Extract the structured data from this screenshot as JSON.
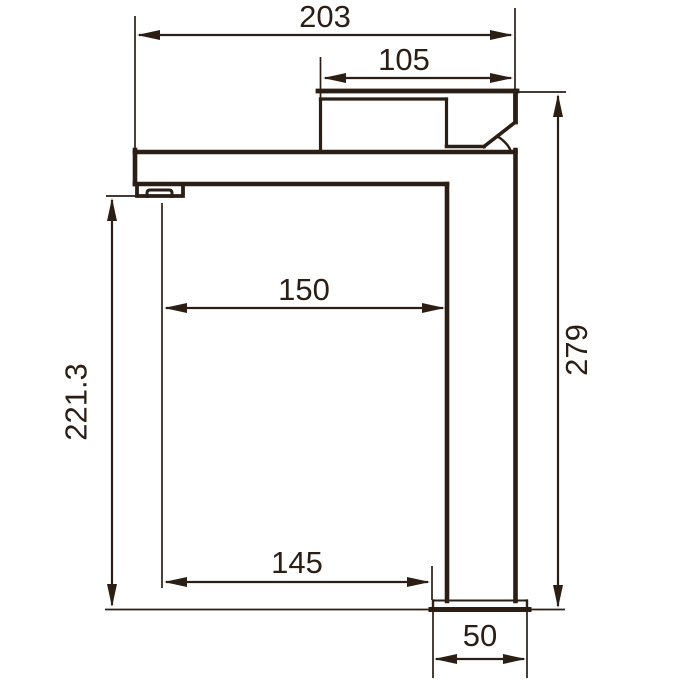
{
  "drawing": {
    "background_color": "#ffffff",
    "line_color": "#2b1e15"
  },
  "dimensions": {
    "overall_length": "203",
    "spout_top_length": "105",
    "spout_reach": "150",
    "height_to_aerator": "221.3",
    "overall_height": "279",
    "aerator_to_base_length": "145",
    "base_width": "50"
  }
}
